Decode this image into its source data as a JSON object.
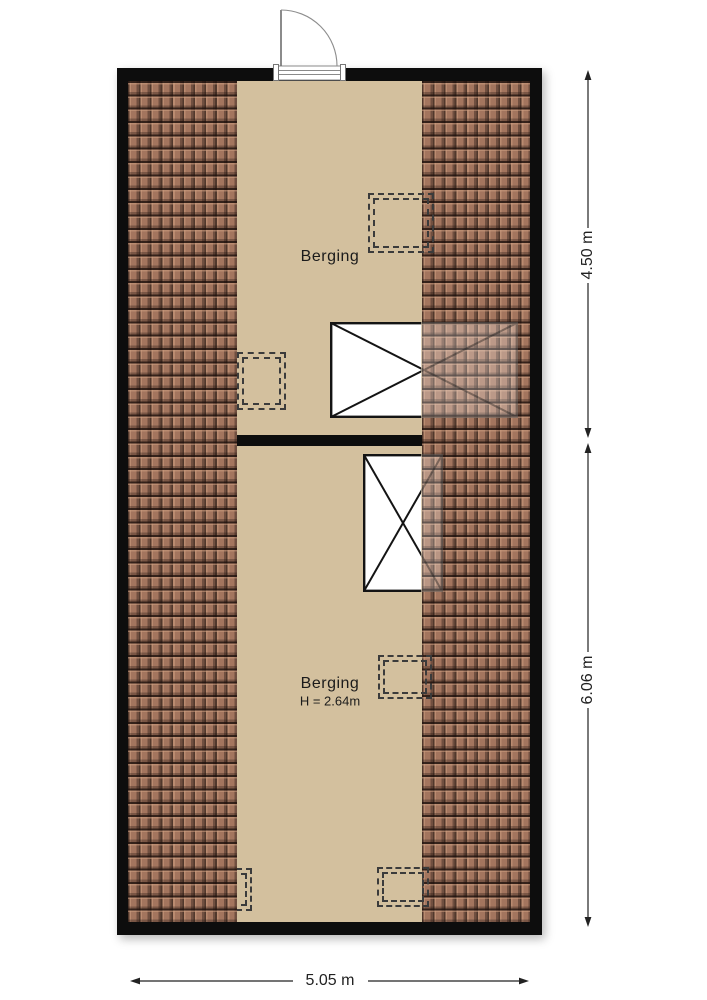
{
  "plan": {
    "type": "floorplan",
    "rooms": [
      {
        "label": "Berging"
      },
      {
        "label": "Berging",
        "height_label": "H = 2.64m"
      }
    ],
    "dimensions": [
      {
        "label": "4.50 m",
        "orientation": "vertical",
        "side": "right",
        "refers_to": "top room depth"
      },
      {
        "label": "6.06 m",
        "orientation": "vertical",
        "side": "right",
        "refers_to": "bottom room depth"
      },
      {
        "label": "5.05 m",
        "orientation": "horizontal",
        "side": "bottom",
        "refers_to": "overall width"
      }
    ],
    "features": {
      "door": "single swing door, top wall, opens outward",
      "roof_windows": 2,
      "dashed_openings": 5
    },
    "colors": {
      "wall": "#0d0d0d",
      "floor": "#d3c09e",
      "roof_tile": "#a3755e",
      "dash_marker": "#3b3b3b",
      "dimension_line": "#222222",
      "background": "#ffffff"
    }
  }
}
